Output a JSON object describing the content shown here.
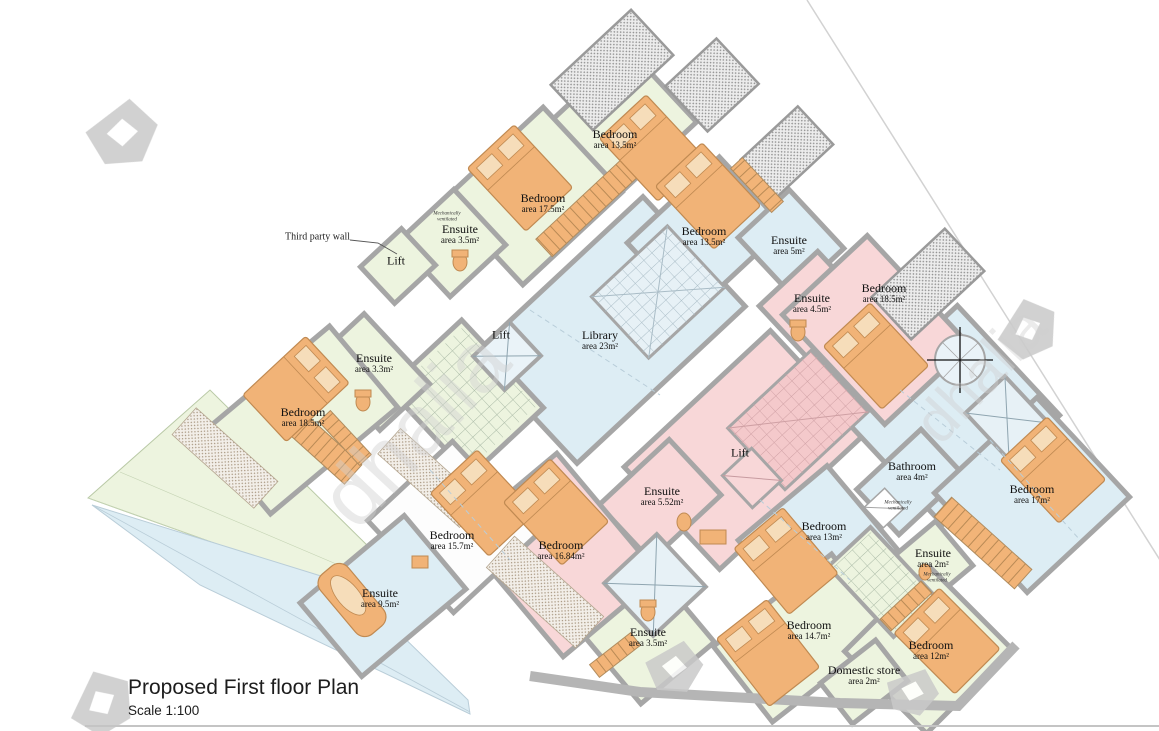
{
  "title": {
    "heading": "Proposed First floor Plan",
    "scale": "Scale 1:100"
  },
  "annotations": {
    "third_party_wall": "Third party wall",
    "mech_vent": "Mechanically ventilated",
    "watermark": "dhalia"
  },
  "rooms": [
    {
      "name": "Bedroom",
      "area": "area 13.5m²"
    },
    {
      "name": "Bedroom",
      "area": "area 17.5m²"
    },
    {
      "name": "Ensuite",
      "area": "area 3.5m²"
    },
    {
      "name": "Bedroom",
      "area": "area 13.5m²"
    },
    {
      "name": "Ensuite",
      "area": "area 5m²"
    },
    {
      "name": "Ensuite",
      "area": "area 4.5m²"
    },
    {
      "name": "Bedroom",
      "area": "area 18.5m²"
    },
    {
      "name": "Library",
      "area": "area 23m²"
    },
    {
      "name": "Ensuite",
      "area": "area 3.3m²"
    },
    {
      "name": "Bedroom",
      "area": "area 18.5m²"
    },
    {
      "name": "Bathroom",
      "area": "area 4m²"
    },
    {
      "name": "Bedroom",
      "area": "area 17m²"
    },
    {
      "name": "Ensuite",
      "area": "area 5.52m²"
    },
    {
      "name": "Bedroom",
      "area": "area 15.7m²"
    },
    {
      "name": "Bedroom",
      "area": "area 16.84m²"
    },
    {
      "name": "Bedroom",
      "area": "area 13m²"
    },
    {
      "name": "Ensuite",
      "area": "area 2m²"
    },
    {
      "name": "Ensuite",
      "area": "area 9.5m²"
    },
    {
      "name": "Ensuite",
      "area": "area 3.5m²"
    },
    {
      "name": "Bedroom",
      "area": "area 14.7m²"
    },
    {
      "name": "Bedroom",
      "area": "area 12m²"
    },
    {
      "name": "Domestic store",
      "area": "area 2m²"
    }
  ],
  "lifts": [
    {
      "label": "Lift"
    },
    {
      "label": "Lift"
    },
    {
      "label": "Lift"
    }
  ],
  "colors": {
    "room_green": "#edf4df",
    "room_blue": "#ddedf4",
    "room_pink": "#f8d7d8",
    "furniture_orange": "#f1b377",
    "wall_gray": "#a6a6a6"
  }
}
